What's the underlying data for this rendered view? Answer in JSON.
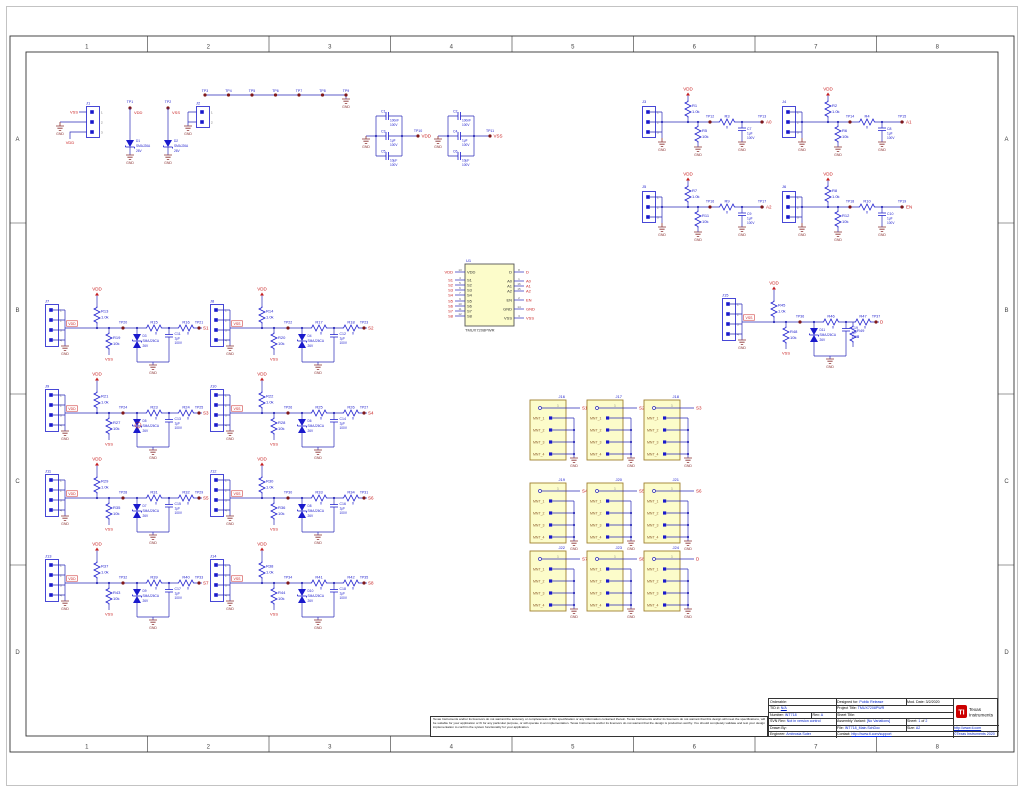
{
  "sheet": {
    "zones_columns": [
      "1",
      "2",
      "3",
      "4",
      "5",
      "6",
      "7",
      "8"
    ],
    "zones_rows": [
      "A",
      "B",
      "C",
      "D"
    ]
  },
  "top_left": {
    "j1": {
      "ref": "J1",
      "pins": [
        "1",
        "2",
        "3"
      ],
      "net_top": "VSS",
      "net_bottom": "VDD",
      "gnd": "GND"
    },
    "tp1": {
      "ref": "TP1",
      "net": "VDD",
      "diode_ref": "D1",
      "diode_part": "SMAJ26A",
      "diode_volt": "26V",
      "gnd": "GND"
    },
    "tp2": {
      "ref": "TP2",
      "net": "VSS",
      "diode_ref": "D2",
      "diode_part": "SMAJ26A",
      "diode_volt": "26V",
      "gnd": "GND"
    },
    "j2": {
      "ref": "J2",
      "pins": [
        "1",
        "2"
      ],
      "net": "GND"
    }
  },
  "tp_row": {
    "tps": [
      "TP3",
      "TP4",
      "TP5",
      "TP6",
      "TP7",
      "TP8",
      "TP9"
    ],
    "gnd": "GND"
  },
  "cap_banks": [
    {
      "caps": [
        {
          "ref": "C1",
          "val": "100nF",
          "volt": "100V"
        },
        {
          "ref": "C3",
          "val": "1µF",
          "volt": "100V"
        },
        {
          "ref": "C5",
          "val": "10µF",
          "volt": "100V"
        }
      ],
      "tp": "TP10",
      "net": "VDD",
      "gnd": "GND"
    },
    {
      "caps": [
        {
          "ref": "C2",
          "val": "100nF",
          "volt": "100V"
        },
        {
          "ref": "C4",
          "val": "1µF",
          "volt": "100V"
        },
        {
          "ref": "C6",
          "val": "10µF",
          "volt": "100V"
        }
      ],
      "tp": "TP11",
      "net": "VSS",
      "gnd": "GND"
    }
  ],
  "logic_blocks": [
    {
      "conn": "J3",
      "pins": [
        "1",
        "2",
        "3"
      ],
      "vdd": "VDD",
      "pu_ref": "R1",
      "pu_val": "1.0k",
      "pd_ref": "R5",
      "pd_val": "10k",
      "tp_mid": "TP12",
      "rs_ref": "R3",
      "rs_val": "0",
      "cap_ref": "C7",
      "cap_val": "1µF",
      "cap_volt": "100V",
      "tp_out": "TP13",
      "net": "A0",
      "gnd": "GND"
    },
    {
      "conn": "J4",
      "pins": [
        "1",
        "2",
        "3"
      ],
      "vdd": "VDD",
      "pu_ref": "R2",
      "pu_val": "1.0k",
      "pd_ref": "R6",
      "pd_val": "10k",
      "tp_mid": "TP14",
      "rs_ref": "R4",
      "rs_val": "0",
      "cap_ref": "C8",
      "cap_val": "1µF",
      "cap_volt": "100V",
      "tp_out": "TP15",
      "net": "A1",
      "gnd": "GND"
    },
    {
      "conn": "J5",
      "pins": [
        "1",
        "2",
        "3"
      ],
      "vdd": "VDD",
      "pu_ref": "R7",
      "pu_val": "1.0k",
      "pd_ref": "R11",
      "pd_val": "10k",
      "tp_mid": "TP16",
      "rs_ref": "R9",
      "rs_val": "0",
      "cap_ref": "C9",
      "cap_val": "1µF",
      "cap_volt": "100V",
      "tp_out": "TP17",
      "net": "A2",
      "gnd": "GND"
    },
    {
      "conn": "J6",
      "pins": [
        "1",
        "2",
        "3"
      ],
      "vdd": "VDD",
      "pu_ref": "R8",
      "pu_val": "1.0k",
      "pd_ref": "R12",
      "pd_val": "10k",
      "tp_mid": "TP18",
      "rs_ref": "R10",
      "rs_val": "0",
      "cap_ref": "C10",
      "cap_val": "1µF",
      "cap_volt": "100V",
      "tp_out": "TP19",
      "net": "EN",
      "gnd": "GND"
    }
  ],
  "channel_blocks": [
    {
      "conn": "J7",
      "pins": [
        "1",
        "2",
        "3",
        "4"
      ],
      "conn_net": "VDD",
      "vdd": "VDD",
      "pu_ref": "R13",
      "pu_val": "1.0k",
      "pd_ref": "R19",
      "pd_val": "10k",
      "pd_net": "VSS",
      "tp_mid": "TP20",
      "tvs_ref": "D3",
      "tvs_part": "SMAJ26CA",
      "tvs_volt": "26V",
      "r1_ref": "R15",
      "r1_val": "0",
      "cap_ref": "C11",
      "cap_val": "1µF",
      "cap_volt": "100V",
      "r2_ref": "R16",
      "r2_val": "0",
      "tp_out": "TP21",
      "net": "S1",
      "gnd": "GND"
    },
    {
      "conn": "J8",
      "pins": [
        "1",
        "2",
        "3",
        "4"
      ],
      "conn_net": "VSS",
      "vdd": "VDD",
      "pu_ref": "R14",
      "pu_val": "1.0k",
      "pd_ref": "R20",
      "pd_val": "10k",
      "pd_net": "VSS",
      "tp_mid": "TP22",
      "tvs_ref": "D4",
      "tvs_part": "SMAJ26CA",
      "tvs_volt": "26V",
      "r1_ref": "R17",
      "r1_val": "0",
      "cap_ref": "C12",
      "cap_val": "1µF",
      "cap_volt": "100V",
      "r2_ref": "R18",
      "r2_val": "0",
      "tp_out": "TP23",
      "net": "S2",
      "gnd": "GND"
    },
    {
      "conn": "J9",
      "pins": [
        "1",
        "2",
        "3",
        "4"
      ],
      "conn_net": "VDD",
      "vdd": "VDD",
      "pu_ref": "R21",
      "pu_val": "1.0k",
      "pd_ref": "R27",
      "pd_val": "10k",
      "pd_net": "VSS",
      "tp_mid": "TP24",
      "tvs_ref": "D5",
      "tvs_part": "SMAJ26CA",
      "tvs_volt": "26V",
      "r1_ref": "R23",
      "r1_val": "0",
      "cap_ref": "C13",
      "cap_val": "1µF",
      "cap_volt": "100V",
      "r2_ref": "R24",
      "r2_val": "0",
      "tp_out": "TP25",
      "net": "S3",
      "gnd": "GND"
    },
    {
      "conn": "J10",
      "pins": [
        "1",
        "2",
        "3",
        "4"
      ],
      "conn_net": "VSS",
      "vdd": "VDD",
      "pu_ref": "R22",
      "pu_val": "1.0k",
      "pd_ref": "R28",
      "pd_val": "10k",
      "pd_net": "VSS",
      "tp_mid": "TP26",
      "tvs_ref": "D6",
      "tvs_part": "SMAJ26CA",
      "tvs_volt": "26V",
      "r1_ref": "R25",
      "r1_val": "0",
      "cap_ref": "C14",
      "cap_val": "1µF",
      "cap_volt": "100V",
      "r2_ref": "R26",
      "r2_val": "0",
      "tp_out": "TP27",
      "net": "S4",
      "gnd": "GND"
    },
    {
      "conn": "J11",
      "pins": [
        "1",
        "2",
        "3",
        "4"
      ],
      "conn_net": "VDD",
      "vdd": "VDD",
      "pu_ref": "R29",
      "pu_val": "1.0k",
      "pd_ref": "R35",
      "pd_val": "10k",
      "pd_net": "VSS",
      "tp_mid": "TP28",
      "tvs_ref": "D7",
      "tvs_part": "SMAJ26CA",
      "tvs_volt": "26V",
      "r1_ref": "R31",
      "r1_val": "0",
      "cap_ref": "C15",
      "cap_val": "1µF",
      "cap_volt": "100V",
      "r2_ref": "R32",
      "r2_val": "0",
      "tp_out": "TP29",
      "net": "S5",
      "gnd": "GND"
    },
    {
      "conn": "J12",
      "pins": [
        "1",
        "2",
        "3",
        "4"
      ],
      "conn_net": "VSS",
      "vdd": "VDD",
      "pu_ref": "R30",
      "pu_val": "1.0k",
      "pd_ref": "R36",
      "pd_val": "10k",
      "pd_net": "VSS",
      "tp_mid": "TP30",
      "tvs_ref": "D8",
      "tvs_part": "SMAJ26CA",
      "tvs_volt": "26V",
      "r1_ref": "R33",
      "r1_val": "0",
      "cap_ref": "C16",
      "cap_val": "1µF",
      "cap_volt": "100V",
      "r2_ref": "R34",
      "r2_val": "0",
      "tp_out": "TP31",
      "net": "S6",
      "gnd": "GND"
    },
    {
      "conn": "J13",
      "pins": [
        "1",
        "2",
        "3",
        "4"
      ],
      "conn_net": "VDD",
      "vdd": "VDD",
      "pu_ref": "R37",
      "pu_val": "1.0k",
      "pd_ref": "R43",
      "pd_val": "10k",
      "pd_net": "VSS",
      "tp_mid": "TP32",
      "tvs_ref": "D9",
      "tvs_part": "SMAJ26CA",
      "tvs_volt": "26V",
      "r1_ref": "R39",
      "r1_val": "0",
      "cap_ref": "C17",
      "cap_val": "1µF",
      "cap_volt": "100V",
      "r2_ref": "R40",
      "r2_val": "0",
      "tp_out": "TP33",
      "net": "S7",
      "gnd": "GND"
    },
    {
      "conn": "J14",
      "pins": [
        "1",
        "2",
        "3",
        "4"
      ],
      "conn_net": "VSS",
      "vdd": "VDD",
      "pu_ref": "R38",
      "pu_val": "1.0k",
      "pd_ref": "R44",
      "pd_val": "10k",
      "pd_net": "VSS",
      "tp_mid": "TP34",
      "tvs_ref": "D10",
      "tvs_part": "SMAJ26CA",
      "tvs_volt": "26V",
      "r1_ref": "R41",
      "r1_val": "0",
      "cap_ref": "C18",
      "cap_val": "1µF",
      "cap_volt": "100V",
      "r2_ref": "R42",
      "r2_val": "0",
      "tp_out": "TP35",
      "net": "S8",
      "gnd": "GND"
    },
    {
      "conn": "J15",
      "pins": [
        "1",
        "2",
        "3",
        "4"
      ],
      "conn_net": "VSS",
      "vdd": "VDD",
      "pu_ref": "R45",
      "pu_val": "1.0k",
      "pd_ref": "R48",
      "pd_val": "10k",
      "pd_net": "VSS",
      "tp_mid": "TP36",
      "tvs_ref": "D11",
      "tvs_part": "SMAJ26CA",
      "tvs_volt": "26V",
      "r1_ref": "R46",
      "r1_val": "0",
      "cap_ref": "C19",
      "cap_val": "1µF",
      "cap_volt": "100V",
      "r2_ref": "R47",
      "r2_val": "0",
      "tp_out": "TP37",
      "net": "D",
      "gnd": "GND"
    }
  ],
  "drain_extra": {
    "ref": "R49",
    "val": "0"
  },
  "note_marker": "1",
  "sma_blocks": [
    {
      "ref": "J16",
      "pin1": "1",
      "net": "S1",
      "mnt": [
        "MNT_1",
        "MNT_2",
        "MNT_3",
        "MNT_4"
      ],
      "gnd": "GND"
    },
    {
      "ref": "J17",
      "pin1": "1",
      "net": "S2",
      "mnt": [
        "MNT_1",
        "MNT_2",
        "MNT_3",
        "MNT_4"
      ],
      "gnd": "GND"
    },
    {
      "ref": "J18",
      "pin1": "1",
      "net": "S3",
      "mnt": [
        "MNT_1",
        "MNT_2",
        "MNT_3",
        "MNT_4"
      ],
      "gnd": "GND"
    },
    {
      "ref": "J19",
      "pin1": "1",
      "net": "S4",
      "mnt": [
        "MNT_1",
        "MNT_2",
        "MNT_3",
        "MNT_4"
      ],
      "gnd": "GND"
    },
    {
      "ref": "J20",
      "pin1": "1",
      "net": "S5",
      "mnt": [
        "MNT_1",
        "MNT_2",
        "MNT_3",
        "MNT_4"
      ],
      "gnd": "GND"
    },
    {
      "ref": "J21",
      "pin1": "1",
      "net": "S6",
      "mnt": [
        "MNT_1",
        "MNT_2",
        "MNT_3",
        "MNT_4"
      ],
      "gnd": "GND"
    },
    {
      "ref": "J22",
      "pin1": "1",
      "net": "S7",
      "mnt": [
        "MNT_1",
        "MNT_2",
        "MNT_3",
        "MNT_4"
      ],
      "gnd": "GND"
    },
    {
      "ref": "J23",
      "pin1": "1",
      "net": "S8",
      "mnt": [
        "MNT_1",
        "MNT_2",
        "MNT_3",
        "MNT_4"
      ],
      "gnd": "GND"
    },
    {
      "ref": "J24",
      "pin1": "1",
      "net": "D",
      "mnt": [
        "MNT_1",
        "MNT_2",
        "MNT_3",
        "MNT_4"
      ],
      "gnd": "GND"
    }
  ],
  "ic": {
    "ref": "U1",
    "part": "TMUX7208PWR",
    "left_pins": [
      {
        "num": "13",
        "name": "VDD",
        "net": "VDD"
      },
      {
        "num": "4",
        "name": "S1",
        "net": "S1"
      },
      {
        "num": "5",
        "name": "S2",
        "net": "S2"
      },
      {
        "num": "6",
        "name": "S3",
        "net": "S3"
      },
      {
        "num": "7",
        "name": "S4",
        "net": "S4"
      },
      {
        "num": "9",
        "name": "S5",
        "net": "S5"
      },
      {
        "num": "10",
        "name": "S6",
        "net": "S6"
      },
      {
        "num": "11",
        "name": "S7",
        "net": "S7"
      },
      {
        "num": "12",
        "name": "S8",
        "net": "S8"
      }
    ],
    "right_pins": [
      {
        "num": "8",
        "name": "D",
        "net": "D"
      },
      {
        "num": "1",
        "name": "A0",
        "net": "A0"
      },
      {
        "num": "16",
        "name": "A1",
        "net": "A1"
      },
      {
        "num": "15",
        "name": "A2",
        "net": "A2"
      },
      {
        "num": "2",
        "name": "EN",
        "net": "EN"
      },
      {
        "num": "14",
        "name": "GND",
        "net": "GND"
      },
      {
        "num": "3",
        "name": "VSS",
        "net": "VSS"
      }
    ]
  },
  "title_block": {
    "orderable_label": "Orderable:",
    "tid_label": "TID #:",
    "tid": "N/A",
    "number_label": "Number:",
    "number": "INT718",
    "rev_label": "Rev:",
    "rev": "A",
    "svn_label": "SVN Rev:",
    "svn": "Not in version control",
    "drawn_label": "Drawn By:",
    "engineer_label": "Engineer:",
    "engineer": "Ambrosia Suter",
    "designed_label": "Designed for:",
    "designed": "Public Release",
    "mod_date_label": "Mod. Date:",
    "mod_date": "3/2/2020",
    "project_label": "Project Title:",
    "project": "TMUX7208PWR",
    "sheet_title_label": "Sheet Title:",
    "variant_label": "Assembly Variant:",
    "variant": "[No Variations]",
    "sheet_label": "Sheet:",
    "sheet_num": "1",
    "sheet_of": "of",
    "sheet_total": "2",
    "file_label": "File:",
    "file": "INT718_Main.SchDoc",
    "size_label": "Size:",
    "size": "A2",
    "contact_label": "Contact:",
    "contact": "http://www.ti.com/support",
    "logo_line1": "Texas",
    "logo_line2": "Instruments",
    "logo_ti": "TI",
    "ti_url": "http://www.ti.com",
    "copyright": "©Texas Instruments 2020"
  },
  "disclaimer": "Texas Instruments and/or its licensors do not warrant the accuracy or completeness of this specification or any information contained therein. Texas Instruments and/or its licensors do not warrant that this design will meet the specifications, will be suitable for your application or fit for any particular purpose, or will operate in an implementation. Texas Instruments and/or its licensors do not warrant that the design is production worthy. You should completely validate and test your design implementation to confirm the system functionality for your application."
}
